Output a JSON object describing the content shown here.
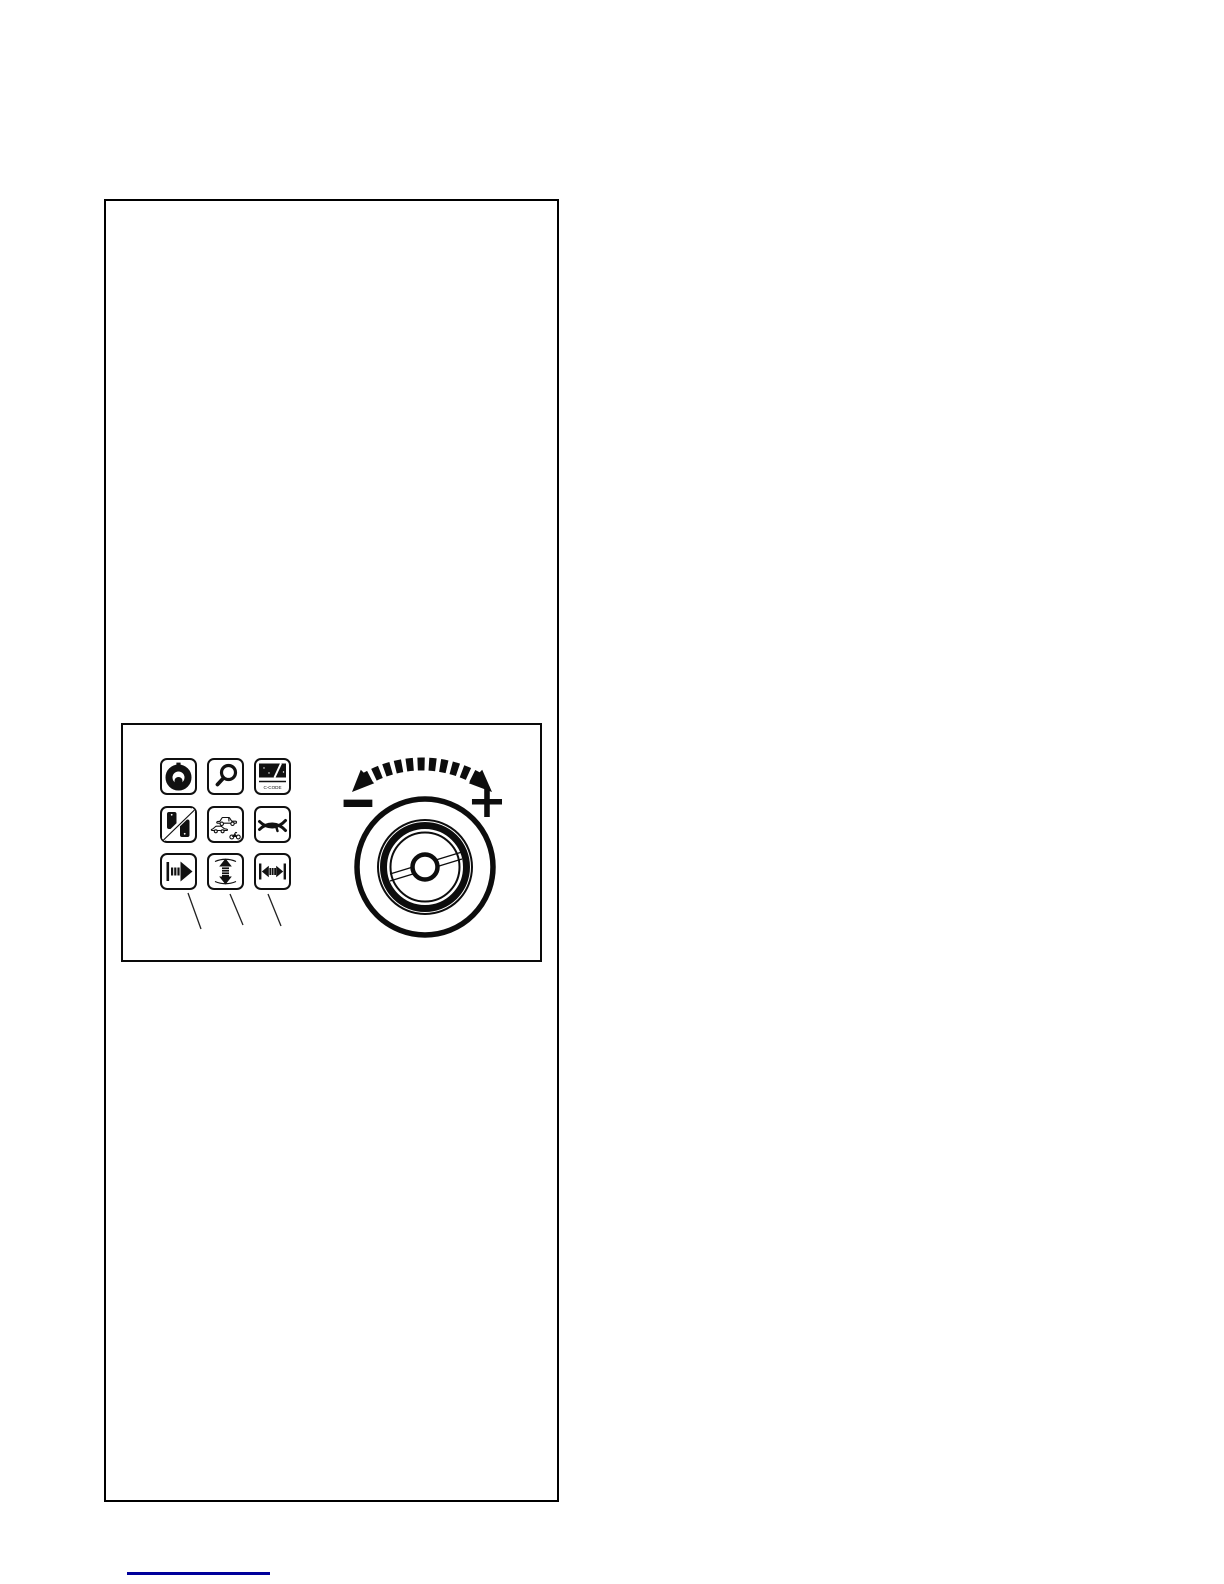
{
  "page": {
    "background": "#ffffff"
  },
  "figure": {
    "border_color": "#000000"
  },
  "panel": {
    "border_color": "#0a0a0a",
    "ink_color": "#111111",
    "buttons": [
      {
        "name": "wheel-optimization",
        "icon": "wheel-optimization-icon"
      },
      {
        "name": "fine-readout",
        "icon": "magnifier-icon"
      },
      {
        "name": "c-code",
        "icon": "c-code-display-icon",
        "label": "C-CODE"
      },
      {
        "name": "weight-split",
        "icon": "split-weight-blocks-icon"
      },
      {
        "name": "vehicle-type",
        "icon": "vehicle-type-icon"
      },
      {
        "name": "spoke-mode",
        "icon": "wheel-spokes-icon"
      },
      {
        "name": "rim-distance",
        "icon": "distance-arrow-icon"
      },
      {
        "name": "rim-diameter",
        "icon": "diameter-arrow-icon"
      },
      {
        "name": "rim-width",
        "icon": "width-arrow-icon"
      }
    ],
    "knob": {
      "minus_label": "−",
      "plus_label": "+"
    }
  },
  "footer": {
    "rule_color": "#00009B"
  }
}
